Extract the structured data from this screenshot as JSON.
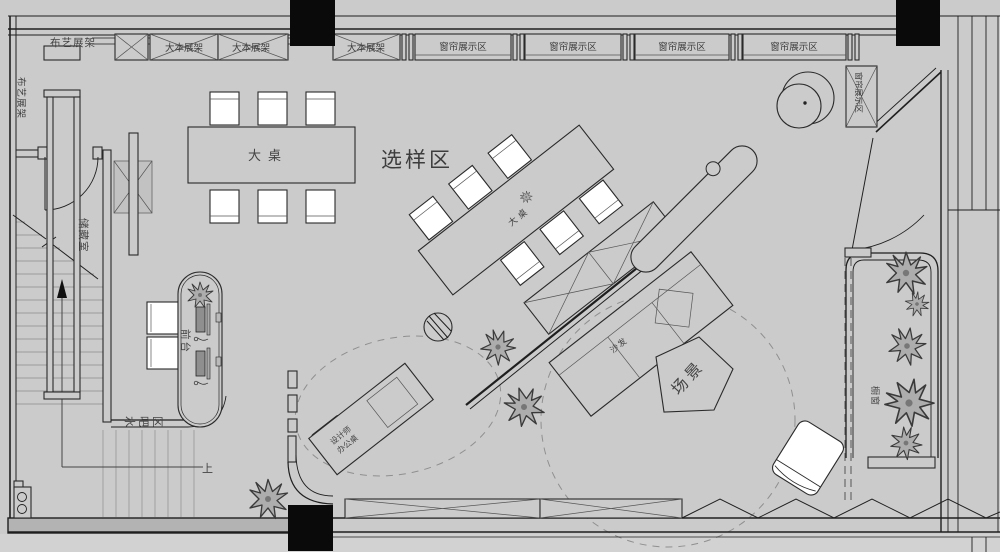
{
  "meta": {
    "kind": "architectural floor plan - fabric/curtain showroom",
    "width": 1000,
    "height": 552
  },
  "palette": {
    "background": "#cbcbcb",
    "wall_line": "#1f1f1f",
    "column_fill": "#0a0a0a",
    "furniture_fill": "#ffffff",
    "muted_line": "#9b9b9b",
    "label_color": "#3d3d3d"
  },
  "labels": {
    "zones": {
      "sample_area": "选样区",
      "scene": "场景",
      "water_bar": "水吧区",
      "storage": "储藏室",
      "reception": "前台",
      "display_window": "橱窗",
      "stairs_up": "上"
    },
    "racks": {
      "fabric_top": "布艺展架",
      "fabric_left": "布艺展架",
      "book_1": "大本展架",
      "book_2": "大本展架",
      "book_3": "大本展架",
      "curtain_1": "窗帘展示区",
      "curtain_2": "窗帘展示区",
      "curtain_3": "窗帘展示区",
      "curtain_4": "窗帘展示区",
      "curtain_side": "窗帘展示区"
    },
    "furniture": {
      "big_table": "大桌",
      "diagonal_table": "大桌",
      "sofa": "沙发",
      "designer_desk_line1": "设计师",
      "designer_desk_line2": "办公桌"
    }
  }
}
